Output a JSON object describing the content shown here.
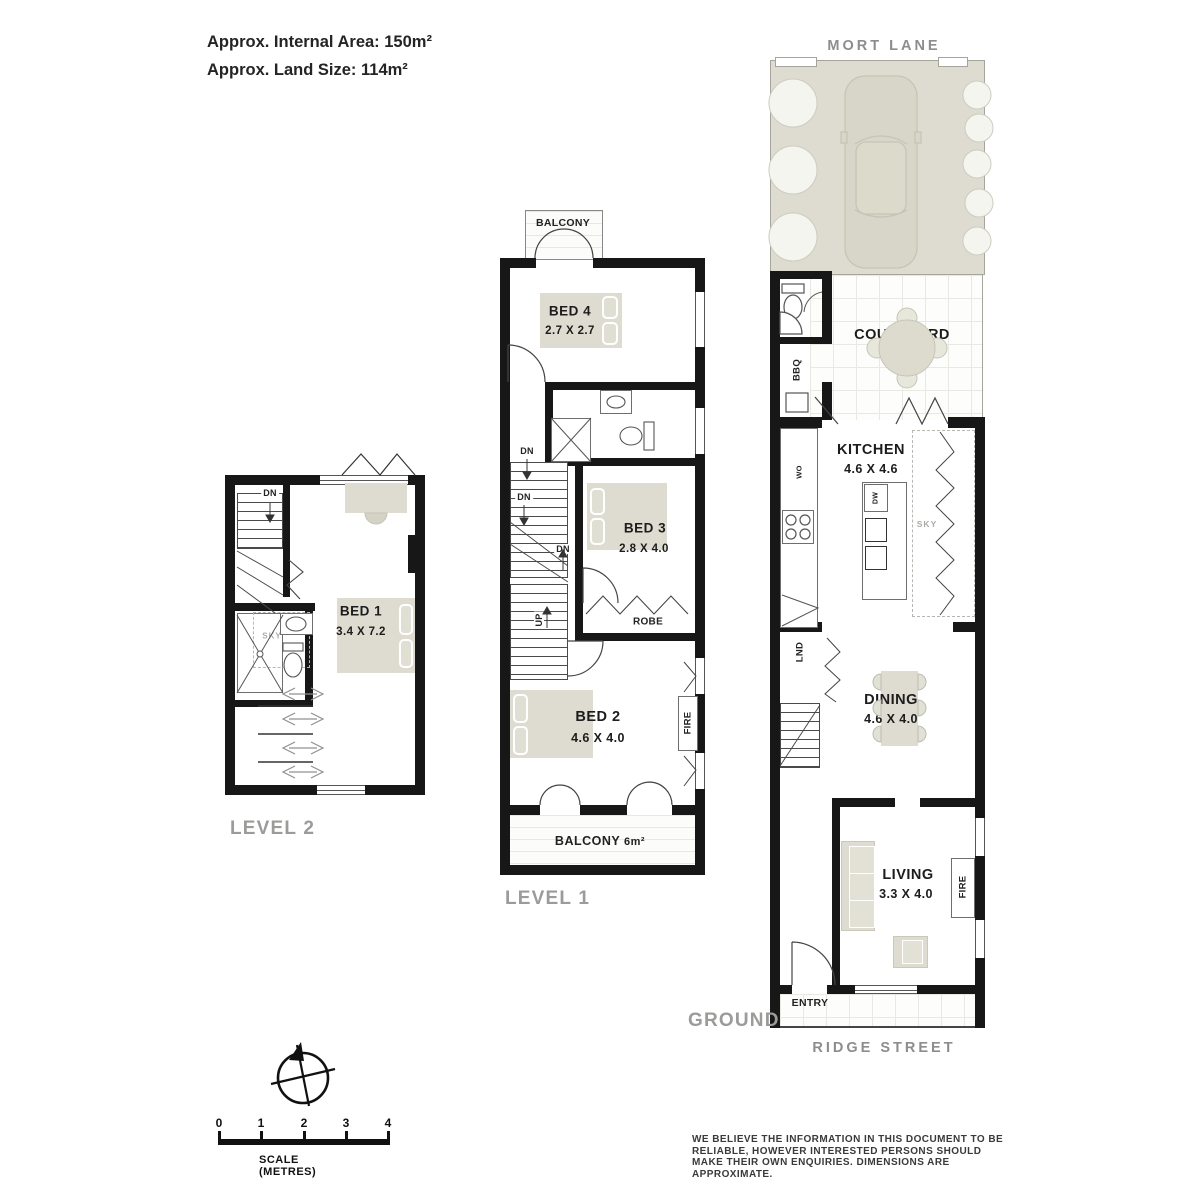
{
  "colors": {
    "wall": "#171717",
    "beige": "#dedcd0",
    "grey_label": "#9b9b99",
    "text": "#1c1c1c"
  },
  "header": {
    "internal_area": "Approx. Internal Area: 150m²",
    "land_size": "Approx. Land Size: 114m²"
  },
  "streets": {
    "top": "MORT LANE",
    "bottom": "RIDGE STREET"
  },
  "level_labels": {
    "ground": "GROUND",
    "level1": "LEVEL 1",
    "level2": "LEVEL 2"
  },
  "ground": {
    "lawn": "LAWN",
    "courtyard": {
      "name": "COURTYARD",
      "area": "17m²"
    },
    "kitchen": {
      "name": "KITCHEN",
      "dims": "4.6 X 4.6"
    },
    "dining": {
      "name": "DINING",
      "dims": "4.6 X 4.0"
    },
    "living": {
      "name": "LIVING",
      "dims": "3.3 X 4.0"
    },
    "entry": "ENTRY",
    "bbq": "BBQ",
    "lnd": "LND",
    "dw": "DW",
    "wo": "WO",
    "sky": "SKY",
    "fire": "FIRE"
  },
  "level1": {
    "balcony_top": "BALCONY",
    "bed4": {
      "name": "BED 4",
      "dims": "2.7 X 2.7"
    },
    "bed3": {
      "name": "BED 3",
      "dims": "2.8 X 4.0"
    },
    "bed2": {
      "name": "BED 2",
      "dims": "4.6 X 4.0"
    },
    "robe": "ROBE",
    "fire": "FIRE",
    "dn": "DN",
    "up": "UP",
    "balcony_bottom": {
      "name": "BALCONY",
      "area": "6m²"
    }
  },
  "level2": {
    "bed1": {
      "name": "BED 1",
      "dims": "3.4 X 7.2"
    },
    "dn": "DN",
    "sky": "SKY"
  },
  "scale_bar": {
    "ticks": [
      "0",
      "1",
      "2",
      "3",
      "4"
    ],
    "caption": "SCALE (METRES)"
  },
  "disclaimer": "WE BELIEVE THE INFORMATION IN THIS DOCUMENT TO BE RELIABLE, HOWEVER INTERESTED PERSONS SHOULD MAKE THEIR OWN ENQUIRIES. DIMENSIONS ARE APPROXIMATE."
}
